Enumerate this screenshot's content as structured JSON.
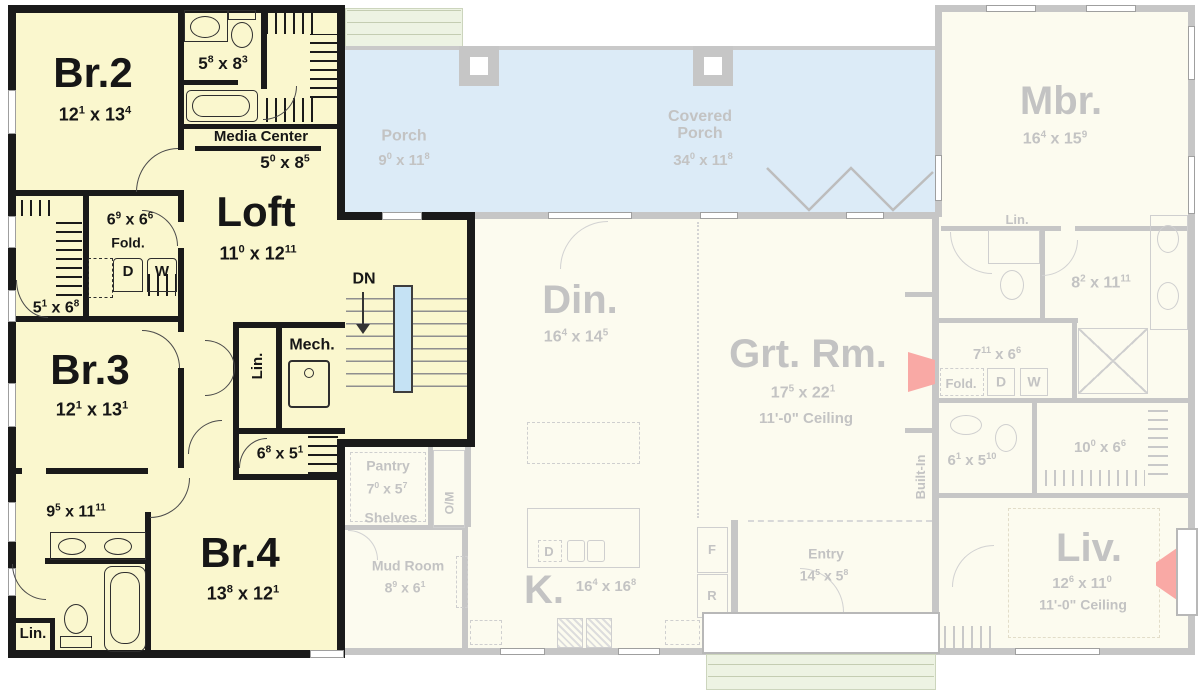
{
  "t": {
    "x": "x"
  },
  "colors": {
    "active_fill": "#FAF7CE",
    "active_wall": "#1A1A1A",
    "faded_fill": "#FCFBEF",
    "faded_wall": "#C6C6C6",
    "faded_text": "#C3C3C3",
    "porch_fill": "#DCEBF7",
    "steps_fill": "#EDF3E3",
    "stair_rail": "#C5E2F4",
    "fireplace": "#F9A9A5"
  },
  "upper_floor": {
    "br2": {
      "name": "Br.2",
      "dim": {
        "w": "12",
        "ws": "1",
        "h": "13",
        "hs": "4"
      }
    },
    "bath2": {
      "dim": {
        "w": "5",
        "ws": "8",
        "h": "8",
        "hs": "3"
      }
    },
    "media": {
      "name": "Media Center",
      "dim": {
        "w": "5",
        "ws": "0",
        "h": "8",
        "hs": "5"
      }
    },
    "loft": {
      "name": "Loft",
      "dim": {
        "w": "11",
        "ws": "0",
        "h": "12",
        "hs": "11"
      }
    },
    "laundry": {
      "dim": {
        "w": "6",
        "ws": "9",
        "h": "6",
        "hs": "6"
      },
      "fold": "Fold.",
      "dryer": "D",
      "washer": "W"
    },
    "closet23": {
      "dim": {
        "w": "5",
        "ws": "1",
        "h": "6",
        "hs": "8"
      }
    },
    "br3": {
      "name": "Br.3",
      "dim": {
        "w": "12",
        "ws": "1",
        "h": "13",
        "hs": "1"
      }
    },
    "stairs": {
      "label": "DN"
    },
    "linen": {
      "label": "Lin."
    },
    "mech": {
      "name": "Mech."
    },
    "closet4": {
      "dim": {
        "w": "6",
        "ws": "8",
        "h": "5",
        "hs": "1"
      }
    },
    "bath34": {
      "dim": {
        "w": "9",
        "ws": "5",
        "h": "11",
        "hs": "11"
      }
    },
    "br4": {
      "name": "Br.4",
      "dim": {
        "w": "13",
        "ws": "8",
        "h": "12",
        "hs": "1"
      }
    },
    "linen2": {
      "label": "Lin."
    }
  },
  "main_floor": {
    "porch": {
      "name": "Porch",
      "dim": {
        "w": "9",
        "ws": "0",
        "h": "11",
        "hs": "8"
      }
    },
    "covered": {
      "name": "Covered Porch",
      "dim": {
        "w": "34",
        "ws": "0",
        "h": "11",
        "hs": "8"
      }
    },
    "mbr": {
      "name": "Mbr.",
      "dim": {
        "w": "16",
        "ws": "4",
        "h": "15",
        "hs": "9"
      }
    },
    "mbr_linen": {
      "label": "Lin."
    },
    "mbath": {
      "dim": {
        "w": "8",
        "ws": "2",
        "h": "11",
        "hs": "11"
      }
    },
    "mlaundry": {
      "dim": {
        "w": "7",
        "ws": "11",
        "h": "6",
        "hs": "6"
      },
      "fold": "Fold.",
      "dryer": "D",
      "washer": "W"
    },
    "powder": {
      "dim": {
        "w": "6",
        "ws": "1",
        "h": "5",
        "hs": "10"
      }
    },
    "wic": {
      "dim": {
        "w": "10",
        "ws": "0",
        "h": "6",
        "hs": "6"
      }
    },
    "din": {
      "name": "Din.",
      "dim": {
        "w": "16",
        "ws": "4",
        "h": "14",
        "hs": "5"
      }
    },
    "grt": {
      "name": "Grt. Rm.",
      "dim": {
        "w": "17",
        "ws": "5",
        "h": "22",
        "hs": "1"
      },
      "ceiling": "11'-0\" Ceiling"
    },
    "builtin": {
      "label": "Built-In"
    },
    "pantry": {
      "name": "Pantry",
      "dim": {
        "w": "7",
        "ws": "0",
        "h": "5",
        "hs": "7"
      },
      "shelves": "Shelves"
    },
    "om": {
      "label": "O/M"
    },
    "mud": {
      "name": "Mud Room",
      "dim": {
        "w": "8",
        "ws": "9",
        "h": "6",
        "hs": "1"
      }
    },
    "kitchen": {
      "name": "K.",
      "dim": {
        "w": "16",
        "ws": "4",
        "h": "16",
        "hs": "8"
      },
      "dishwasher": "D",
      "fridge": "F",
      "range": "R"
    },
    "entry": {
      "name": "Entry",
      "dim": {
        "w": "14",
        "ws": "5",
        "h": "5",
        "hs": "8"
      }
    },
    "liv": {
      "name": "Liv.",
      "dim": {
        "w": "12",
        "ws": "6",
        "h": "11",
        "hs": "0"
      },
      "ceiling": "11'-0\" Ceiling"
    }
  }
}
